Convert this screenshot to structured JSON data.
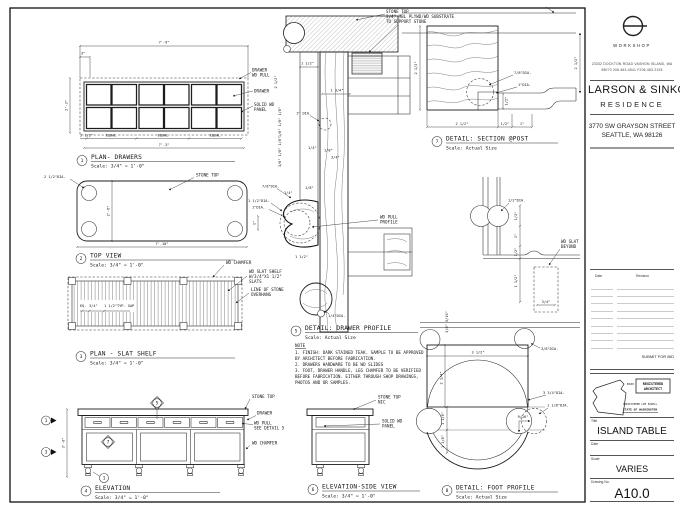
{
  "titleblock": {
    "firm": "WORKSHOP",
    "address1": "23332 DOCKTON ROAD  VASHON ISLAND, WA",
    "address2": "98070   206.463.4541   F206.463.2193",
    "client": "LARSON & SINKO",
    "client_sub": "RESIDENCE",
    "project_address1": "3770 SW GRAYSON STREET",
    "project_address2": "SEATTLE, WA 98126",
    "rev_date_header": "Date",
    "rev_revision_header": "Revision",
    "submit_for_bid": "SUBMIT FOR BID",
    "stamp_number": "8029",
    "stamp_line1": "REGISTERED",
    "stamp_line2": "ARCHITECT",
    "stamp_name": "CHRISTOPHER LEE EZZELL",
    "stamp_state": "STATE OF WASHINGTON",
    "title_label": "Title",
    "sheet_title": "ISLAND TABLE",
    "date_label": "Date",
    "scale_label": "Scale",
    "scale_value": "VARIES",
    "number_label": "Drawing No.",
    "sheet_number": "A10.0"
  },
  "note": {
    "title": "NOTE",
    "l1": "1. FINISH: DARK STAINED TEAK. SAMPLE TO BE APPROVED",
    "l2": "BY ARCHITECT BEFORE FABRICATION.",
    "l3": "2. DRAWERS HARDWARE TO BE WD SLIDES",
    "l4": "3. FOOT, DRAWER HANDLE, LEG CHAMFER TO BE VERIFIED",
    "l5": "BEFORE FABRICATION. EITHER THROUGH SHOP DRAWINGS,",
    "l6": "PHOTOS AND OR SAMPLES."
  },
  "views": {
    "v1": {
      "num": "1",
      "title": "PLAN- DRAWERS",
      "scale": "Scale: 3/4\" = 1'-0\"",
      "dim_top": "7'-9\"",
      "dim_3": "3\"",
      "dim_left": "2'-3\"",
      "dim_bl": "2 1/2\"",
      "equal": "EQUAL",
      "dim_bottom": "7'-3\"",
      "lbl_drawer1": "DRAWER",
      "lbl_drawer2": "WD PULL",
      "lbl_drawer": "DRAWER",
      "lbl_panel1": "SOLID WD",
      "lbl_panel2": "PANEL"
    },
    "v2": {
      "num": "2",
      "title": "TOP VIEW",
      "scale": "Scale: 3/4\" = 1'-0\"",
      "dia": "2 1/2\"DIA.",
      "stone": "STONE TOP",
      "dim_h": "2'-6\"",
      "dim_w": "7'-10\""
    },
    "v3": {
      "num": "3",
      "title": "PLAN - SLAT SHELF",
      "scale": "Scale: 3/4\" = 1'-0\"",
      "eq": "EQ.",
      "d34": "3/4\"",
      "gap": "1 1/2\"TYP. GAP",
      "chamfer": "WD CHAMFER",
      "slat1": "WD SLAT SHELF",
      "slat2": "W/3/4\"X1 1/2\"",
      "slat3": "SLATS",
      "overhang1": "LINE OF STONE",
      "overhang2": "OVERHANG"
    },
    "v4": {
      "num": "4",
      "title": "ELEVATION",
      "scale": "Scale: 3/4\" = 1'-0\"",
      "dim_h": "3'-0\"",
      "stone": "STONE TOP",
      "drawer": "DRAWER",
      "pull1": "WD PULL",
      "pull2": "SEE DETAIL 5",
      "chamfer": "WD CHAMFER",
      "m1": "1",
      "m3": "3",
      "m5": "5",
      "m7": "7",
      "m8": "1"
    },
    "v5": {
      "num": "5",
      "title": "DETAIL: DRAWER PROFILE",
      "scale": "Scale: Actual Size",
      "stone1": "STONE TOP",
      "stone2": "3/4\" MBL PLYWD/WD SUBSTRATE",
      "stone3": "TO SUPPORT STONE",
      "d112": "1 1/2\"",
      "d212": "2 1/2\"",
      "d134": "1 3/4\"",
      "d1dia": "1\" DIA.",
      "stack1": "1/8\" 1/8\" 1/8\"",
      "stack2": "3/8\" 1/8\" 1/8\"",
      "d78dia": "7/8\"DIA.",
      "d14": "1/4\"",
      "d18": "1/8\"",
      "d14b": "1/4\"",
      "d18b": "1/8\"",
      "d34": "3/4\"",
      "d112dia": "1 1/2\"DIA.",
      "d1dia2": "1\"DIA.",
      "d1": "1\"",
      "d112b": "1 1/2\"",
      "d14dia": "1/4\"DIA.",
      "pull1": "WD PULL",
      "pull2": "PROFILE"
    },
    "v6": {
      "num": "6",
      "title": "ELEVATION-SIDE VIEW",
      "scale": "Scale: 3/4\" = 1'-0\"",
      "stone1": "STONE TOP",
      "stone2": "NIC",
      "panel1": "SOLID WD",
      "panel2": "PANEL"
    },
    "v7": {
      "num": "7",
      "title": "DETAIL: SECTION @POST",
      "scale": "Scale: Actual Size",
      "dim_left": "2 1/2\"",
      "b1": "2 1/2\"",
      "b2": "1/2\"",
      "b3": "1\"",
      "r1": "7/8\"DIA.",
      "r2": "1\"DIA.",
      "r3": "1/2\"",
      "far": "2 1/2\""
    },
    "v8": {
      "num": "8",
      "title": "DETAIL: FOOT PROFILE",
      "scale": "Scale: Actual Size",
      "halfdia": "1/2\"DIA.",
      "slat1": "WD SLAT",
      "slat2": "BEYOND",
      "d34": "3/4\"",
      "c1": "1/2\"",
      "c2": "1\"",
      "c3": "1/2\"",
      "c4": "1 1/2\"",
      "stack": "3/8\" 5/16\"",
      "peg": "3/8\"DIA.",
      "w": "3 1/2\"",
      "h": "2 1/4\"",
      "big": "3 3/4\"DIA.",
      "small": "1 1/8\"DIA.",
      "nine": "9/16\"",
      "e1": "1 1/8\"",
      "e2": "1 1/8\""
    }
  }
}
